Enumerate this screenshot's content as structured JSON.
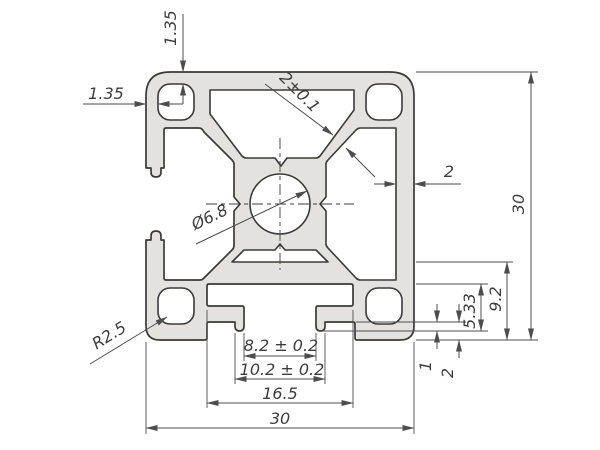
{
  "drawing": {
    "type": "technical-drawing",
    "subject": "aluminium-extrusion-profile-cross-section",
    "colors": {
      "background": "#ffffff",
      "profile_fill": "#e3e2df",
      "outline": "#3a3a38",
      "dimension_lines": "#4d4d4d",
      "text": "#3d3d3d"
    },
    "dimensions": [
      {
        "id": "dim-1-35-top",
        "label": "1.35",
        "x": 176,
        "y": 28,
        "rotate": -90
      },
      {
        "id": "dim-1-35-left",
        "label": "1.35",
        "x": 106,
        "y": 99,
        "rotate": 0
      },
      {
        "id": "dim-2-0-1-web",
        "label": "2±0.1",
        "x": 296,
        "y": 96,
        "rotate": 45
      },
      {
        "id": "dim-dia-6-8",
        "label": "Ø6.8",
        "x": 212,
        "y": 222,
        "rotate": -26
      },
      {
        "id": "dim-2-wall",
        "label": "2",
        "x": 449,
        "y": 177,
        "rotate": 0
      },
      {
        "id": "dim-30-right",
        "label": "30",
        "x": 524,
        "y": 204,
        "rotate": -90
      },
      {
        "id": "dim-9-2",
        "label": "9.2",
        "x": 501,
        "y": 299,
        "rotate": -90
      },
      {
        "id": "dim-5-33",
        "label": "5.33",
        "x": 475,
        "y": 311,
        "rotate": -90
      },
      {
        "id": "dim-1-lip",
        "label": "1",
        "x": 431,
        "y": 366,
        "rotate": -90
      },
      {
        "id": "dim-2-foot",
        "label": "2",
        "x": 453,
        "y": 373,
        "rotate": -90
      },
      {
        "id": "dim-8-2",
        "label": "8.2 ± 0.2",
        "x": 281,
        "y": 351,
        "rotate": 0
      },
      {
        "id": "dim-10-2",
        "label": "10.2 ± 0.2",
        "x": 282,
        "y": 375,
        "rotate": 0
      },
      {
        "id": "dim-16-5",
        "label": "16.5",
        "x": 280,
        "y": 399,
        "rotate": 0
      },
      {
        "id": "dim-30-bottom",
        "label": "30",
        "x": 280,
        "y": 424,
        "rotate": 0
      },
      {
        "id": "dim-r2-5",
        "label": "R2.5",
        "x": 112,
        "y": 340,
        "rotate": -32
      }
    ]
  }
}
